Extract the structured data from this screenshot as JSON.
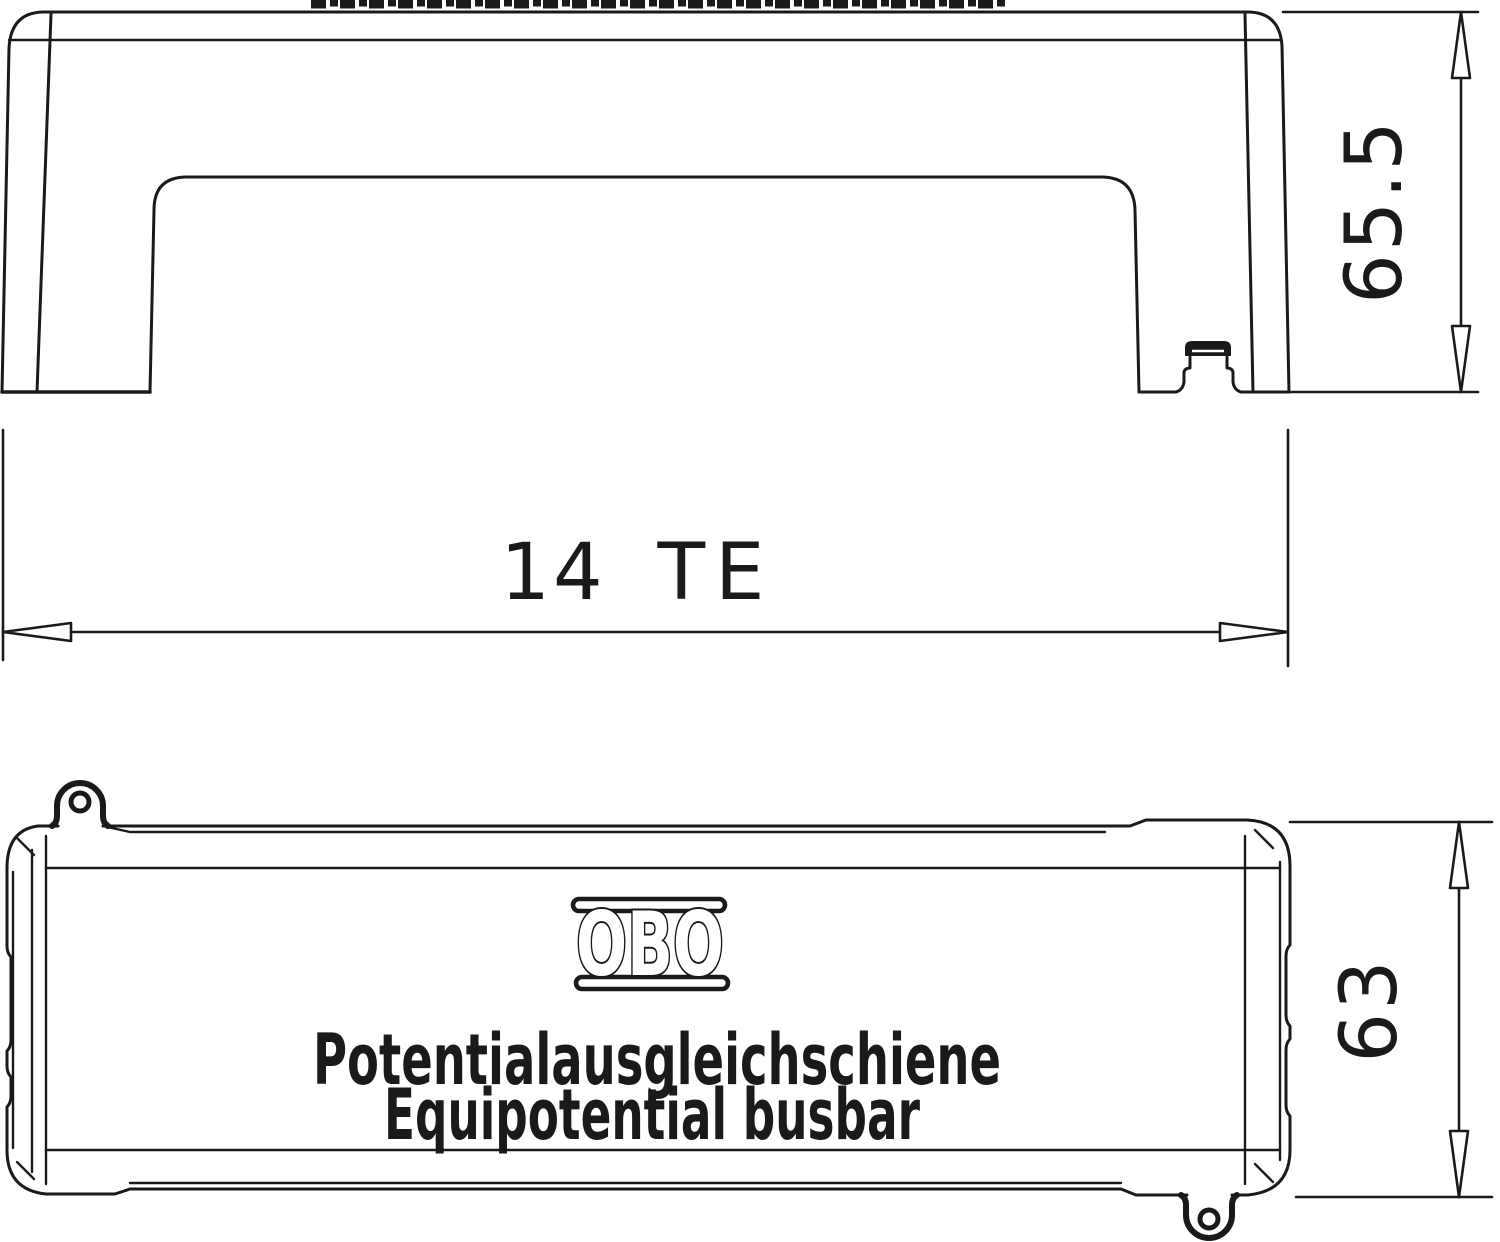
{
  "drawing": {
    "brand": "OBO",
    "product_line1": "Potentialausgleichschiene",
    "product_line2": "Equipotential busbar",
    "dimensions": {
      "side_view_height": "65.5",
      "side_view_width_value": "14",
      "side_view_width_unit": "TE",
      "front_view_height": "63"
    },
    "colors": {
      "line": "#1a1a1a",
      "background": "#ffffff"
    }
  }
}
